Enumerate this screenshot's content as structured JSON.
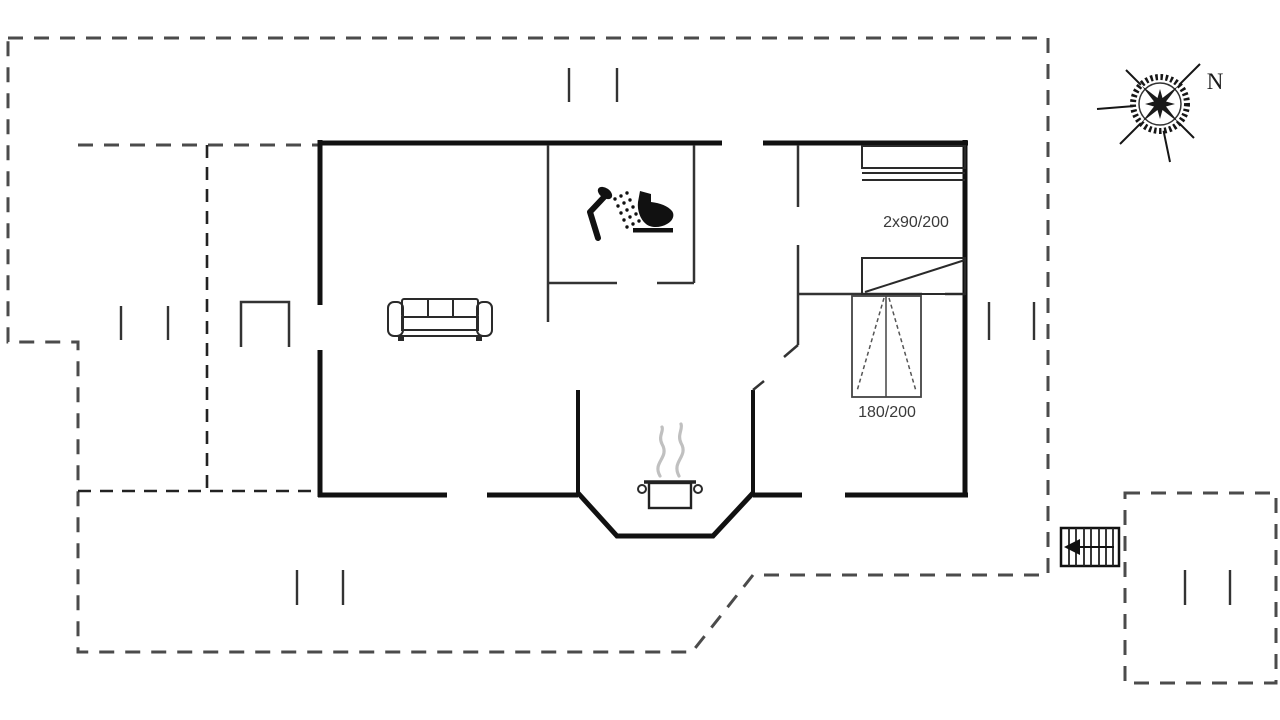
{
  "title": "Holiday home floor plan",
  "compass": {
    "label": "N"
  },
  "rooms": {
    "bunk_bed_label": "2x90/200",
    "double_bed_label": "180/200"
  },
  "icons": {
    "compass": "compass-rose-icon",
    "shower": "shower-icon",
    "toilet": "toilet-icon",
    "sofa": "sofa-icon",
    "cooking_pot": "cooking-pot-icon",
    "steam": "steam-icon",
    "stairs": "stairs-icon",
    "stairs_arrow": "left-arrow-icon"
  },
  "colors": {
    "background": "#ffffff",
    "wall": "#111111",
    "interior-wall": "#333333",
    "terrace-dash": "#4b4b4b",
    "inner-dash": "#222222",
    "furniture": "#2a2a2a",
    "steam": "#c0c0c0",
    "label": "#3a3a3a"
  }
}
